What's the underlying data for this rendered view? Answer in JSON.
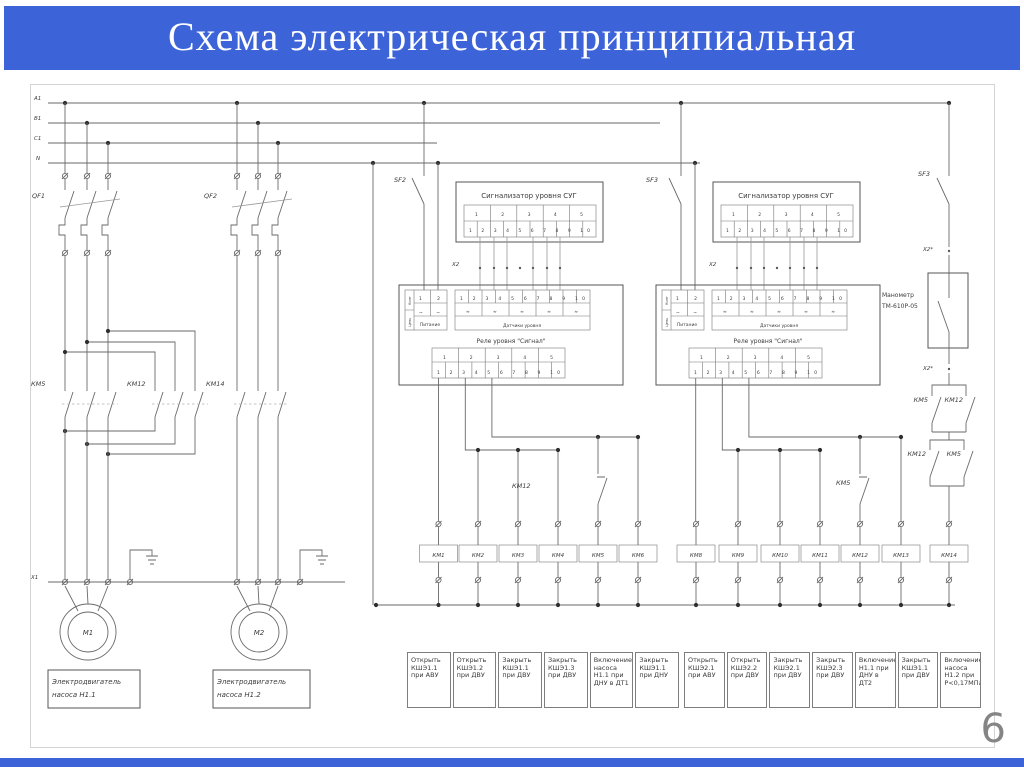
{
  "header": {
    "title": "Схема электрическая принципиальная"
  },
  "footer": {
    "page_number": "6"
  },
  "colors": {
    "header_blue": "#3d63d8",
    "line_gray": "#6a6a6a",
    "page_number_gray": "#858585"
  },
  "schematic": {
    "bus_labels": [
      "А1",
      "В1",
      "С1",
      "N"
    ],
    "breaker_labels": [
      "QF1",
      "QF2"
    ],
    "contactor_labels": [
      "КМ5",
      "КМ12",
      "КМ14"
    ],
    "switch_labels": {
      "sf2": "SF2",
      "sf3_mid": "SF3",
      "sf3_right": "SF3"
    },
    "terminal_x1": "X1",
    "terminal_x2": "X2",
    "terminal_x2_star": "Х2*",
    "motors": [
      {
        "label": "М1",
        "caption_line1": "Электродвигатель",
        "caption_line2": "насоса Н1.1"
      },
      {
        "label": "М2",
        "caption_line1": "Электродвигатель",
        "caption_line2": "насоса Н1.2"
      }
    ],
    "signalizer_title": "Сигнализатор уровня СУГ",
    "row5": "1 2 3 4 5",
    "row10": "1 2 3 4 5 6 7 8 9 10",
    "relay": {
      "power_row_numbers": "1 2",
      "power_row_symbols": "~ ~",
      "power_caption": "Питание",
      "power_col_headers": [
        "Конт",
        "Цепь"
      ],
      "sensor_symbols": "≈ ≈ ≈ ≈ ≈",
      "sensor_caption": "Датчики уровня",
      "caption": "Реле уровня \"Сигнал\""
    },
    "manometer": {
      "line1": "Манометр",
      "line2": "ТМ-610Р-05"
    },
    "pressure_contacts": {
      "pair1_left": "КМ5",
      "pair1_right": "КМ12",
      "pair2_left": "КМ12",
      "pair2_right": "КМ5"
    },
    "series_contacts": {
      "left": "КМ12",
      "right": "КМ5"
    },
    "coils_left": [
      "КМ1",
      "КМ2",
      "КМ3",
      "КМ4",
      "КМ5",
      "КМ6"
    ],
    "coils_right": [
      "КМ8",
      "КМ9",
      "КМ10",
      "КМ11",
      "КМ12",
      "КМ13",
      "КМ14"
    ],
    "descriptions_left": [
      [
        "Открыть",
        "КШЭ1.1",
        "при АВУ"
      ],
      [
        "Открыть",
        "КШЭ1.2",
        "при ДВУ"
      ],
      [
        "Закрыть",
        "КШЭ1.1",
        "при ДВУ"
      ],
      [
        "Закрыть",
        "КШЭ1.3",
        "при ДВУ"
      ],
      [
        "Включение",
        "насоса",
        "Н1.1 при",
        "ДНУ в ДТ1"
      ],
      [
        "Закрыть",
        "КШЭ1.1",
        "при ДНУ"
      ]
    ],
    "descriptions_right": [
      [
        "Открыть",
        "КШЭ2.1",
        "при АВУ"
      ],
      [
        "Открыть",
        "КШЭ2.2",
        "при ДВУ"
      ],
      [
        "Закрыть",
        "КШЭ2.1",
        "при ДВУ"
      ],
      [
        "Закрыть",
        "КШЭ2.3",
        "при ДВУ"
      ],
      [
        "Включение",
        "Н1.1 при",
        "ДНУ в ДТ2"
      ],
      [
        "Закрыть",
        "КШЭ1.1",
        "при ДВУ"
      ],
      [
        "Включение",
        "насоса",
        "Н1.2 при",
        "Р<0,17МПа"
      ]
    ]
  }
}
